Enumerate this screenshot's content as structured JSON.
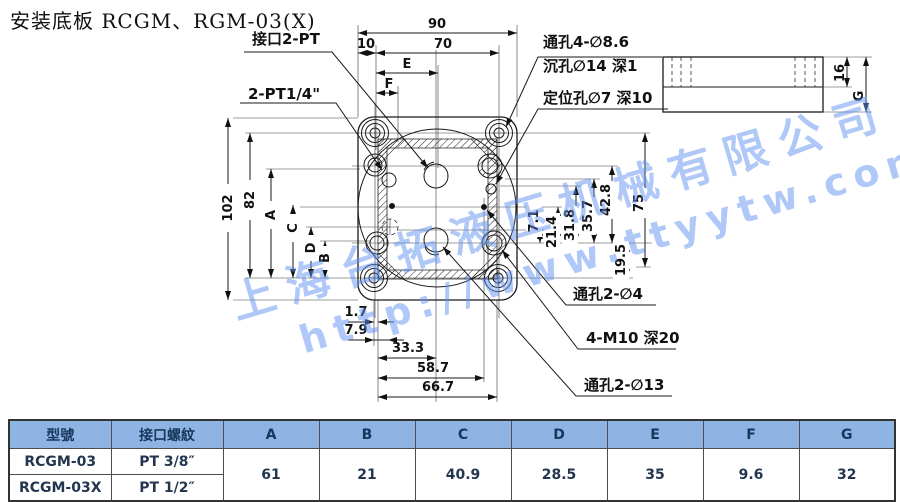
{
  "page": {
    "title": "安装底板 RCGM、RGM-03(X)"
  },
  "watermark": {
    "line1": "上海台拓液压机械有限公司",
    "line2": "http://www.ttyytw.com",
    "color": "#6092f0"
  },
  "drawing": {
    "labels": {
      "port_main": "接口2-PT",
      "port_quarter": "2-PT1/4\"",
      "through_4_86": "通孔4-∅8.6",
      "counterbore": "沉孔∅14 深1",
      "locating_hole": "定位孔∅7 深10",
      "through_2_4": "通孔2-∅4",
      "tapped_m10": "4-M10 深20",
      "through_2_13": "通孔2-∅13"
    },
    "dims": {
      "w90": "90",
      "w70": "70",
      "w10": "10",
      "e": "E",
      "f": "F",
      "h102": "102",
      "h82": "82",
      "a": "A",
      "b": "B",
      "c": "C",
      "d": "D",
      "r71": "7.1",
      "r214": "21.4",
      "r318": "31.8",
      "r357": "35.7",
      "r428": "42.8",
      "r75": "75",
      "r195": "19.5",
      "b17": "1.7",
      "b79": "7.9",
      "b333": "33.3",
      "b587": "58.7",
      "b667": "66.7",
      "s16": "16",
      "sg": "G"
    }
  },
  "table": {
    "header_bg": "#8db4e2",
    "header_fg": "#17375e",
    "headers": [
      "型號",
      "接口螺紋",
      "A",
      "B",
      "C",
      "D",
      "E",
      "F",
      "G"
    ],
    "rows": [
      {
        "model": "RCGM-03",
        "thread": "PT 3/8″"
      },
      {
        "model": "RCGM-03X",
        "thread": "PT 1/2″"
      }
    ],
    "values": {
      "A": "61",
      "B": "21",
      "C": "40.9",
      "D": "28.5",
      "E": "35",
      "F": "9.6",
      "G": "32"
    }
  }
}
